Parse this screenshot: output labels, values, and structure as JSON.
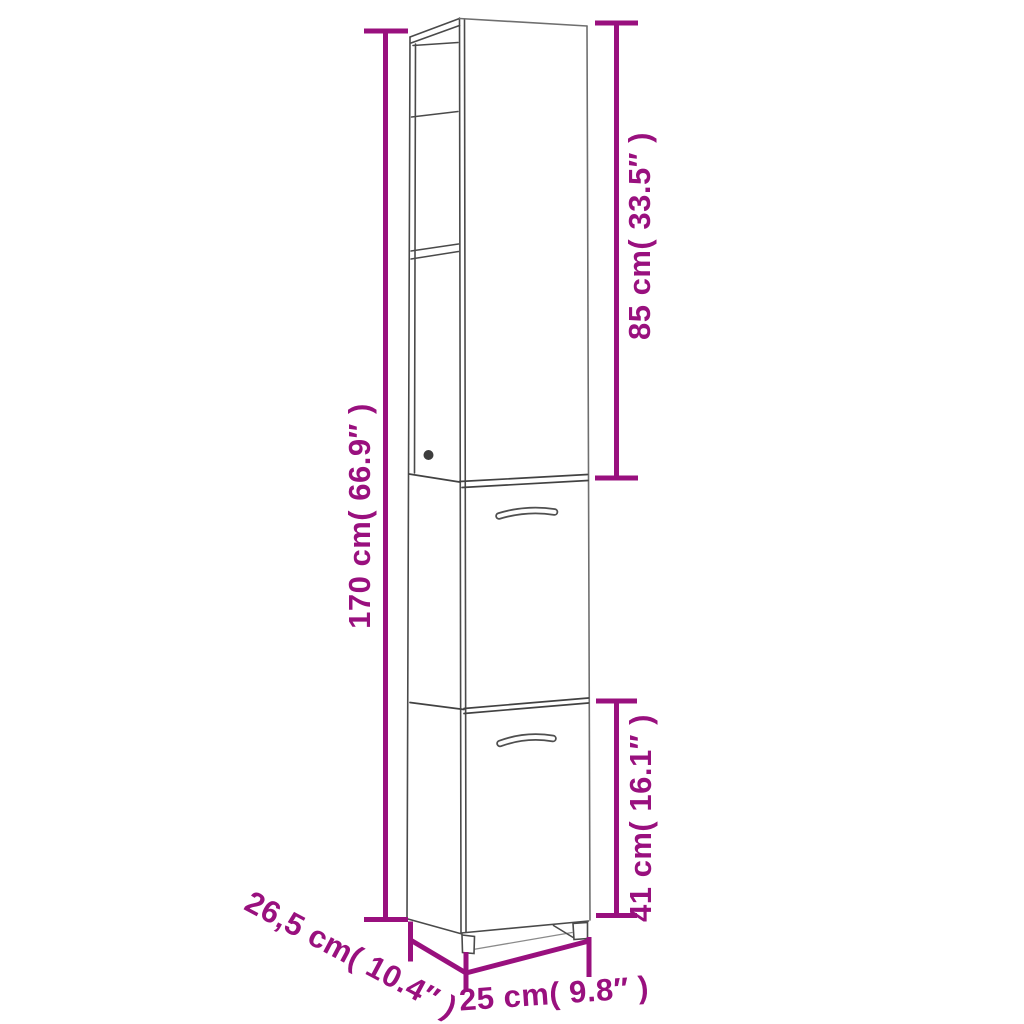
{
  "diagram": {
    "kind": "furniture-dimension-diagram",
    "subject": "tall narrow cabinet with open shelf top section, two doors with handles and small feet",
    "accent_color": "#99107E",
    "drawing_line_color": "#4A4A4A",
    "dimensions": {
      "total_height": {
        "value_cm": "170",
        "value_in": "66.9",
        "label": "170 cm( 66.9″ )"
      },
      "upper_height": {
        "value_cm": "85",
        "value_in": "33.5",
        "label": "85 cm( 33.5″ )"
      },
      "lower_height": {
        "value_cm": "41",
        "value_in": "16.1",
        "label": "41 cm( 16.1″ )"
      },
      "depth": {
        "value_cm": "26,5",
        "value_in": "10.4",
        "label": "26,5 cm( 10.4″ )"
      },
      "width": {
        "value_cm": "25",
        "value_in": "9.8",
        "label": "25 cm( 9.8″ )"
      }
    }
  }
}
